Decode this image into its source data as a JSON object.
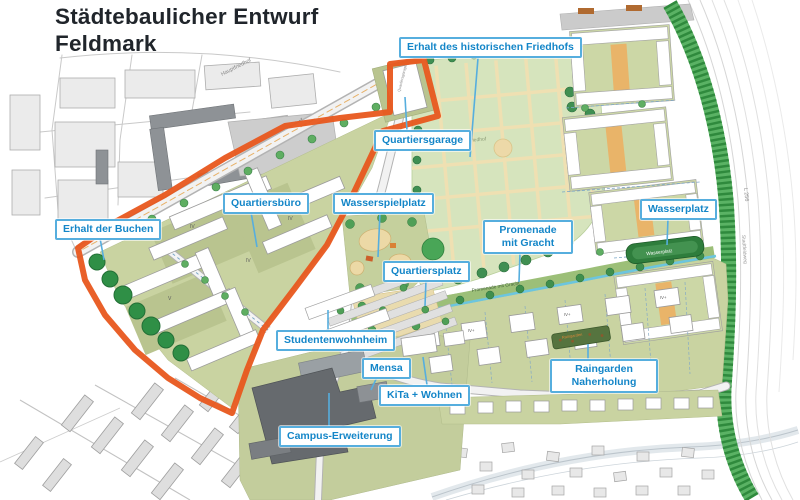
{
  "title": "Städtebaulicher Entwurf\nFeldmark",
  "callouts": [
    {
      "label": "Erhalt des historischen Friedhofs"
    },
    {
      "label": "Quartiersgarage"
    },
    {
      "label": "Wasserspielplatz"
    },
    {
      "label": "Quartiersbüro"
    },
    {
      "label": "Erhalt der Buchen"
    },
    {
      "label": "Promenade mit Gracht"
    },
    {
      "label": "Quartiersplatz"
    },
    {
      "label": "Wasserplatz"
    },
    {
      "label": "Studentenwohnheim"
    },
    {
      "label": "Mensa"
    },
    {
      "label": "KiTa + Wohnen"
    },
    {
      "label": "Campus-Erweiterung"
    },
    {
      "label": "Raingarden Naherholung"
    }
  ],
  "map_texts": {
    "hauptfriedhof": "Hauptfriedhof",
    "planung_betriebshof": "Planung Betriebshof",
    "friedhof": "Friedhof",
    "quartiersgarage_building": "Quartiersgarage",
    "promenade_path": "Promenade mit Gracht",
    "wasserplatz_strip": "Wasserplatz",
    "raingarden_strip": "Raingarden",
    "road_l256": "L 256",
    "road_stadtfeldweg": "Stadtfeldweg"
  },
  "colors": {
    "boundary_orange": "#e8571d",
    "label_blue": "#1486c8",
    "label_border": "#56aede",
    "development_green": "#c9d3a1",
    "cemetery_green": "#d6e4bd",
    "noise_barrier_green": "#3f9e4c",
    "canal_blue": "#6cc5de"
  }
}
